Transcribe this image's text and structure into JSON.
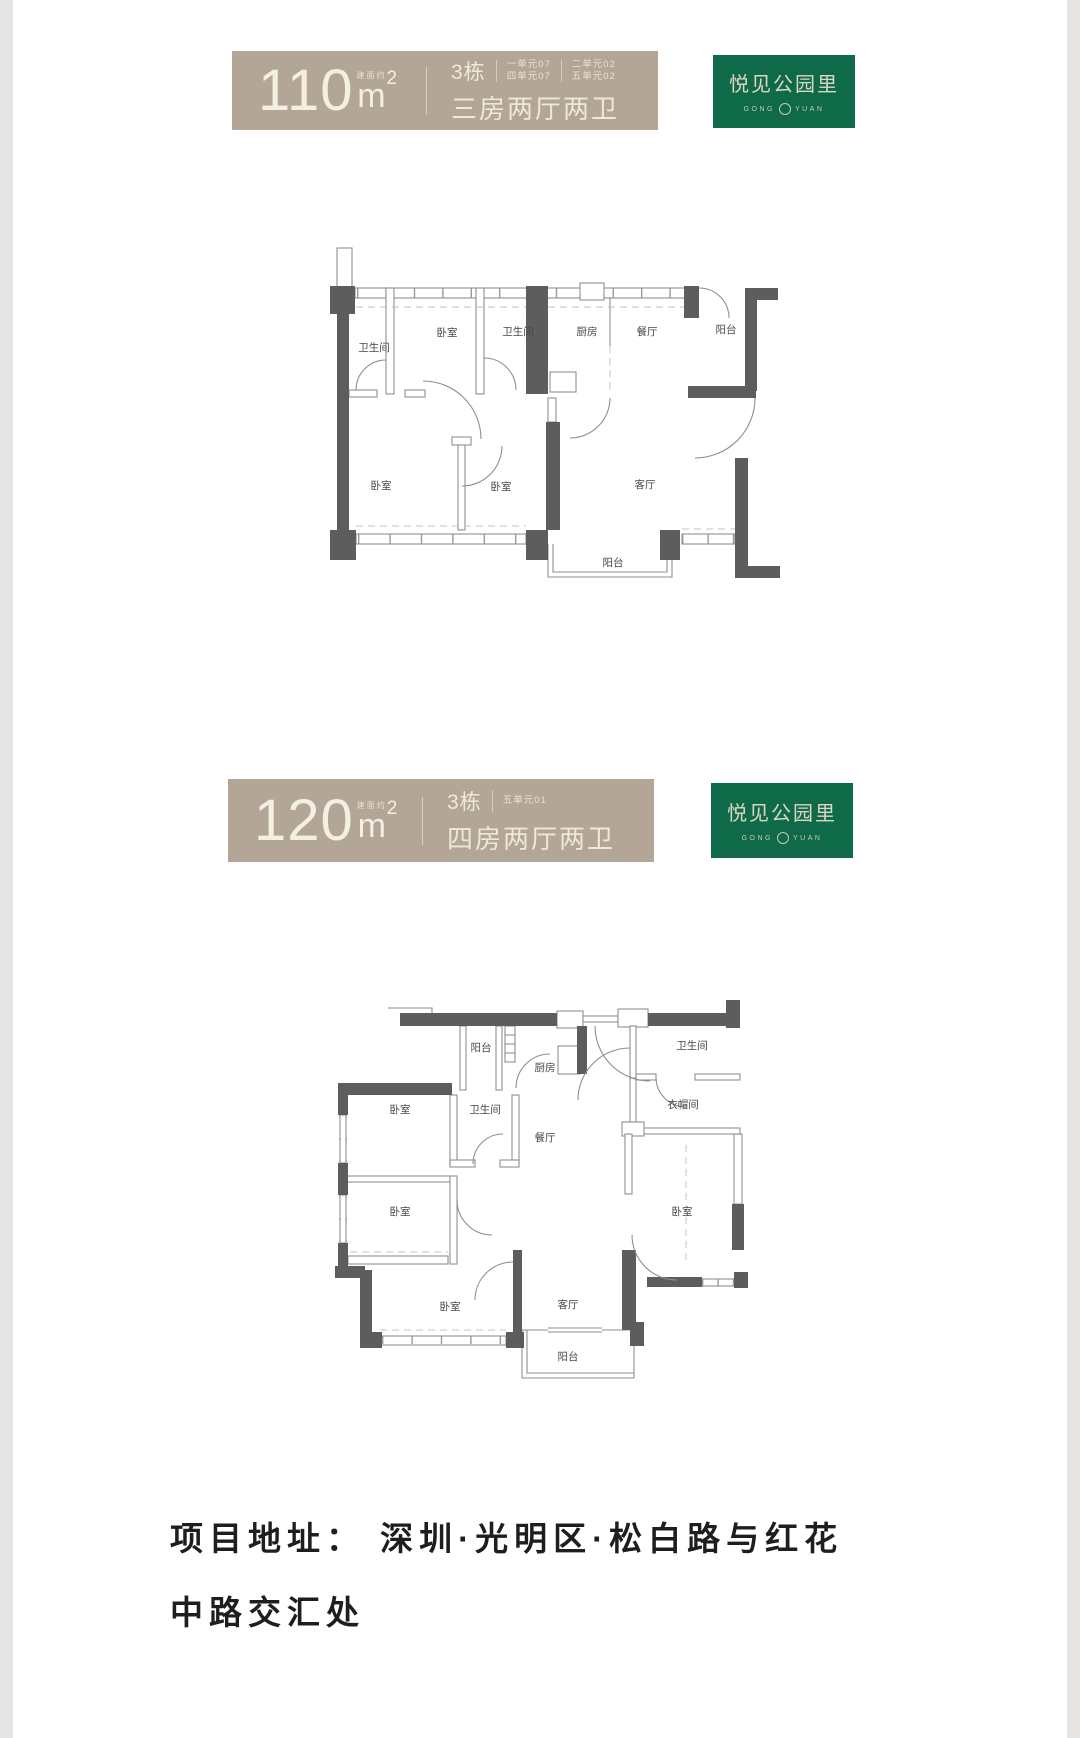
{
  "banners": [
    {
      "area_value": "110",
      "area_note": "建面约",
      "area_unit": "m",
      "area_sup": "2",
      "building": "3栋",
      "unit_columns": [
        {
          "lines": [
            "一单元07",
            "四单元07"
          ]
        },
        {
          "lines": [
            "二单元02",
            "五单元02"
          ]
        }
      ],
      "layout_name": "三房两厅两卫",
      "brand_name": "悦见公园里",
      "brand_sub_left": "GONG",
      "brand_sub_right": "YUAN"
    },
    {
      "area_value": "120",
      "area_note": "建面约",
      "area_unit": "m",
      "area_sup": "2",
      "building": "3栋",
      "unit_columns": [
        {
          "lines": [
            "五单元01"
          ]
        }
      ],
      "layout_name": "四房两厅两卫",
      "brand_name": "悦见公园里",
      "brand_sub_left": "GONG",
      "brand_sub_right": "YUAN"
    }
  ],
  "floorplans": [
    {
      "rooms": {
        "bath1": "卫生间",
        "bed1": "卧室",
        "bath2": "卫生间",
        "kitchen": "厨房",
        "dining": "餐厅",
        "balcony_r": "阳台",
        "bed2": "卧室",
        "bed3": "卧室",
        "living": "客厅",
        "balcony_b": "阳台"
      }
    },
    {
      "rooms": {
        "balcony_t": "阳台",
        "kitchen": "厨房",
        "bath_tr": "卫生间",
        "bed_l1": "卧室",
        "bath_m": "卫生间",
        "dining": "餐厅",
        "cloak": "衣帽间",
        "bed_l2": "卧室",
        "bed_r": "卧室",
        "bed_b": "卧室",
        "living": "客厅",
        "balcony_b": "阳台"
      }
    }
  ],
  "address": {
    "line1": "项目地址： 深圳·光明区·松白路与红花",
    "line2": "中路交汇处"
  },
  "colors": {
    "banner_beige": "#b3a696",
    "brand_green": "#0f6a49",
    "wall_gray": "#5d5d5d",
    "address_text": "#1e1e1e"
  }
}
